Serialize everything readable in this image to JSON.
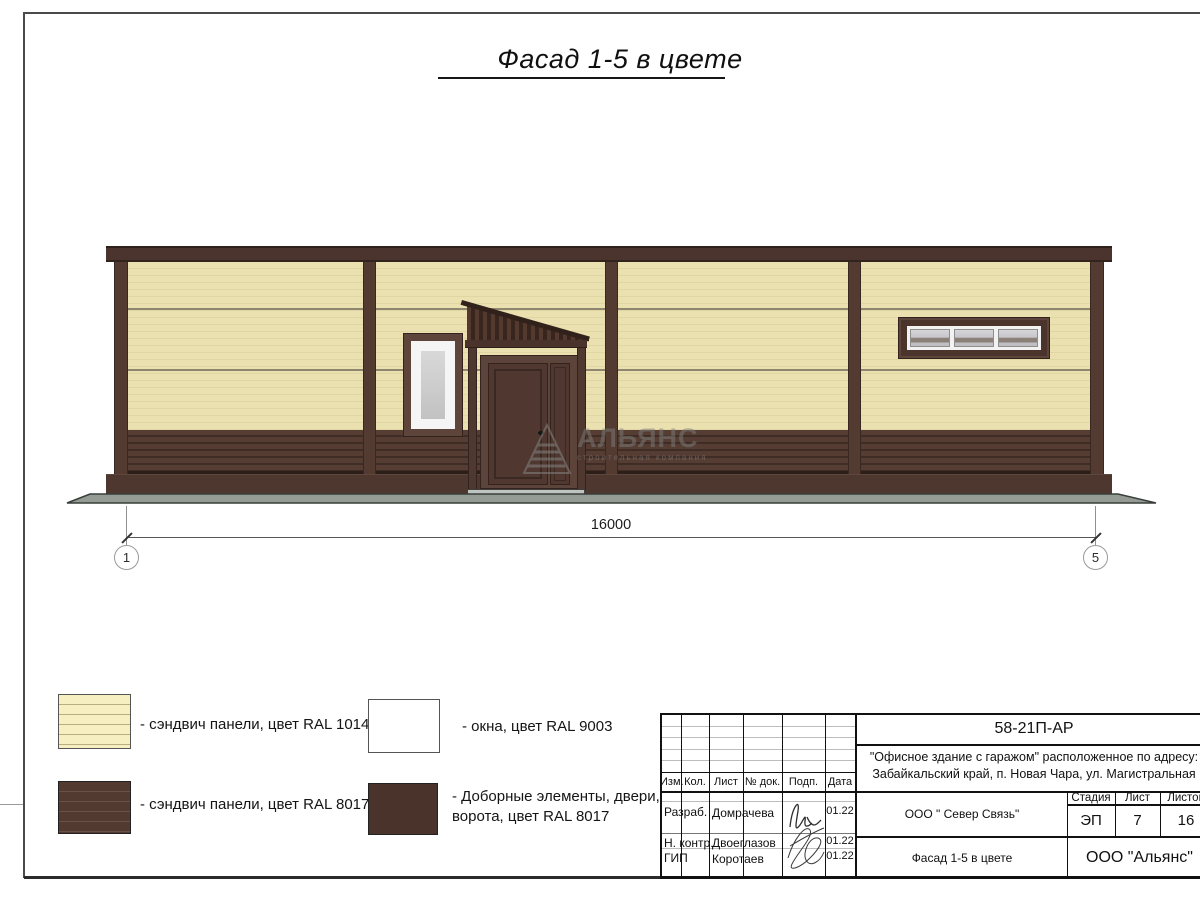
{
  "page": {
    "title": "Фасад 1-5 в цвете"
  },
  "watermark": {
    "name": "АЛЬЯНС",
    "tagline": "строительная компания"
  },
  "dimension": {
    "length_label": "16000",
    "axis_start": "1",
    "axis_end": "5"
  },
  "legend": {
    "items": [
      {
        "label": "- сэндвич панели, цвет RAL 1014"
      },
      {
        "label": "- окна, цвет RAL 9003"
      },
      {
        "label": "- сэндвич панели, цвет RAL 8017"
      },
      {
        "label": "- Доборные элементы, двери,",
        "label2": "ворота, цвет RAL 8017"
      }
    ]
  },
  "titleblock": {
    "doc_number": "58-21П-АР",
    "address_line1": "\"Офисное здание с гаражом\" расположенное по адресу:",
    "address_line2": "Забайкальский край, п. Новая Чара, ул. Магистральная",
    "columns": {
      "izm": "Изм.",
      "kol": "Кол.",
      "list": "Лист",
      "doc": "№ док.",
      "podp": "Подп.",
      "data": "Дата"
    },
    "rows": [
      {
        "role": "Разраб.",
        "name": "Домрачева",
        "date": "01.22"
      },
      {
        "role": "Н. контр.",
        "name": "Двоеглазов",
        "date": "01.22"
      },
      {
        "role": "ГИП",
        "name": "Коротаев",
        "date": "01.22"
      }
    ],
    "org_center": "ООО \" Север Связь\"",
    "sheet_title": "Фасад 1-5 в цвете",
    "stage_label": "Стадия",
    "stage_value": "ЭП",
    "sheet_label": "Лист",
    "sheet_value": "7",
    "sheets_label": "Листов",
    "sheets_value": "16",
    "company": "ООО \"Альянс\""
  },
  "colors": {
    "ral1014_panel": "#e9dfae",
    "ral8017_panel": "#4b342c",
    "ral9003_window": "#cccccc",
    "ground": "#949b95"
  }
}
